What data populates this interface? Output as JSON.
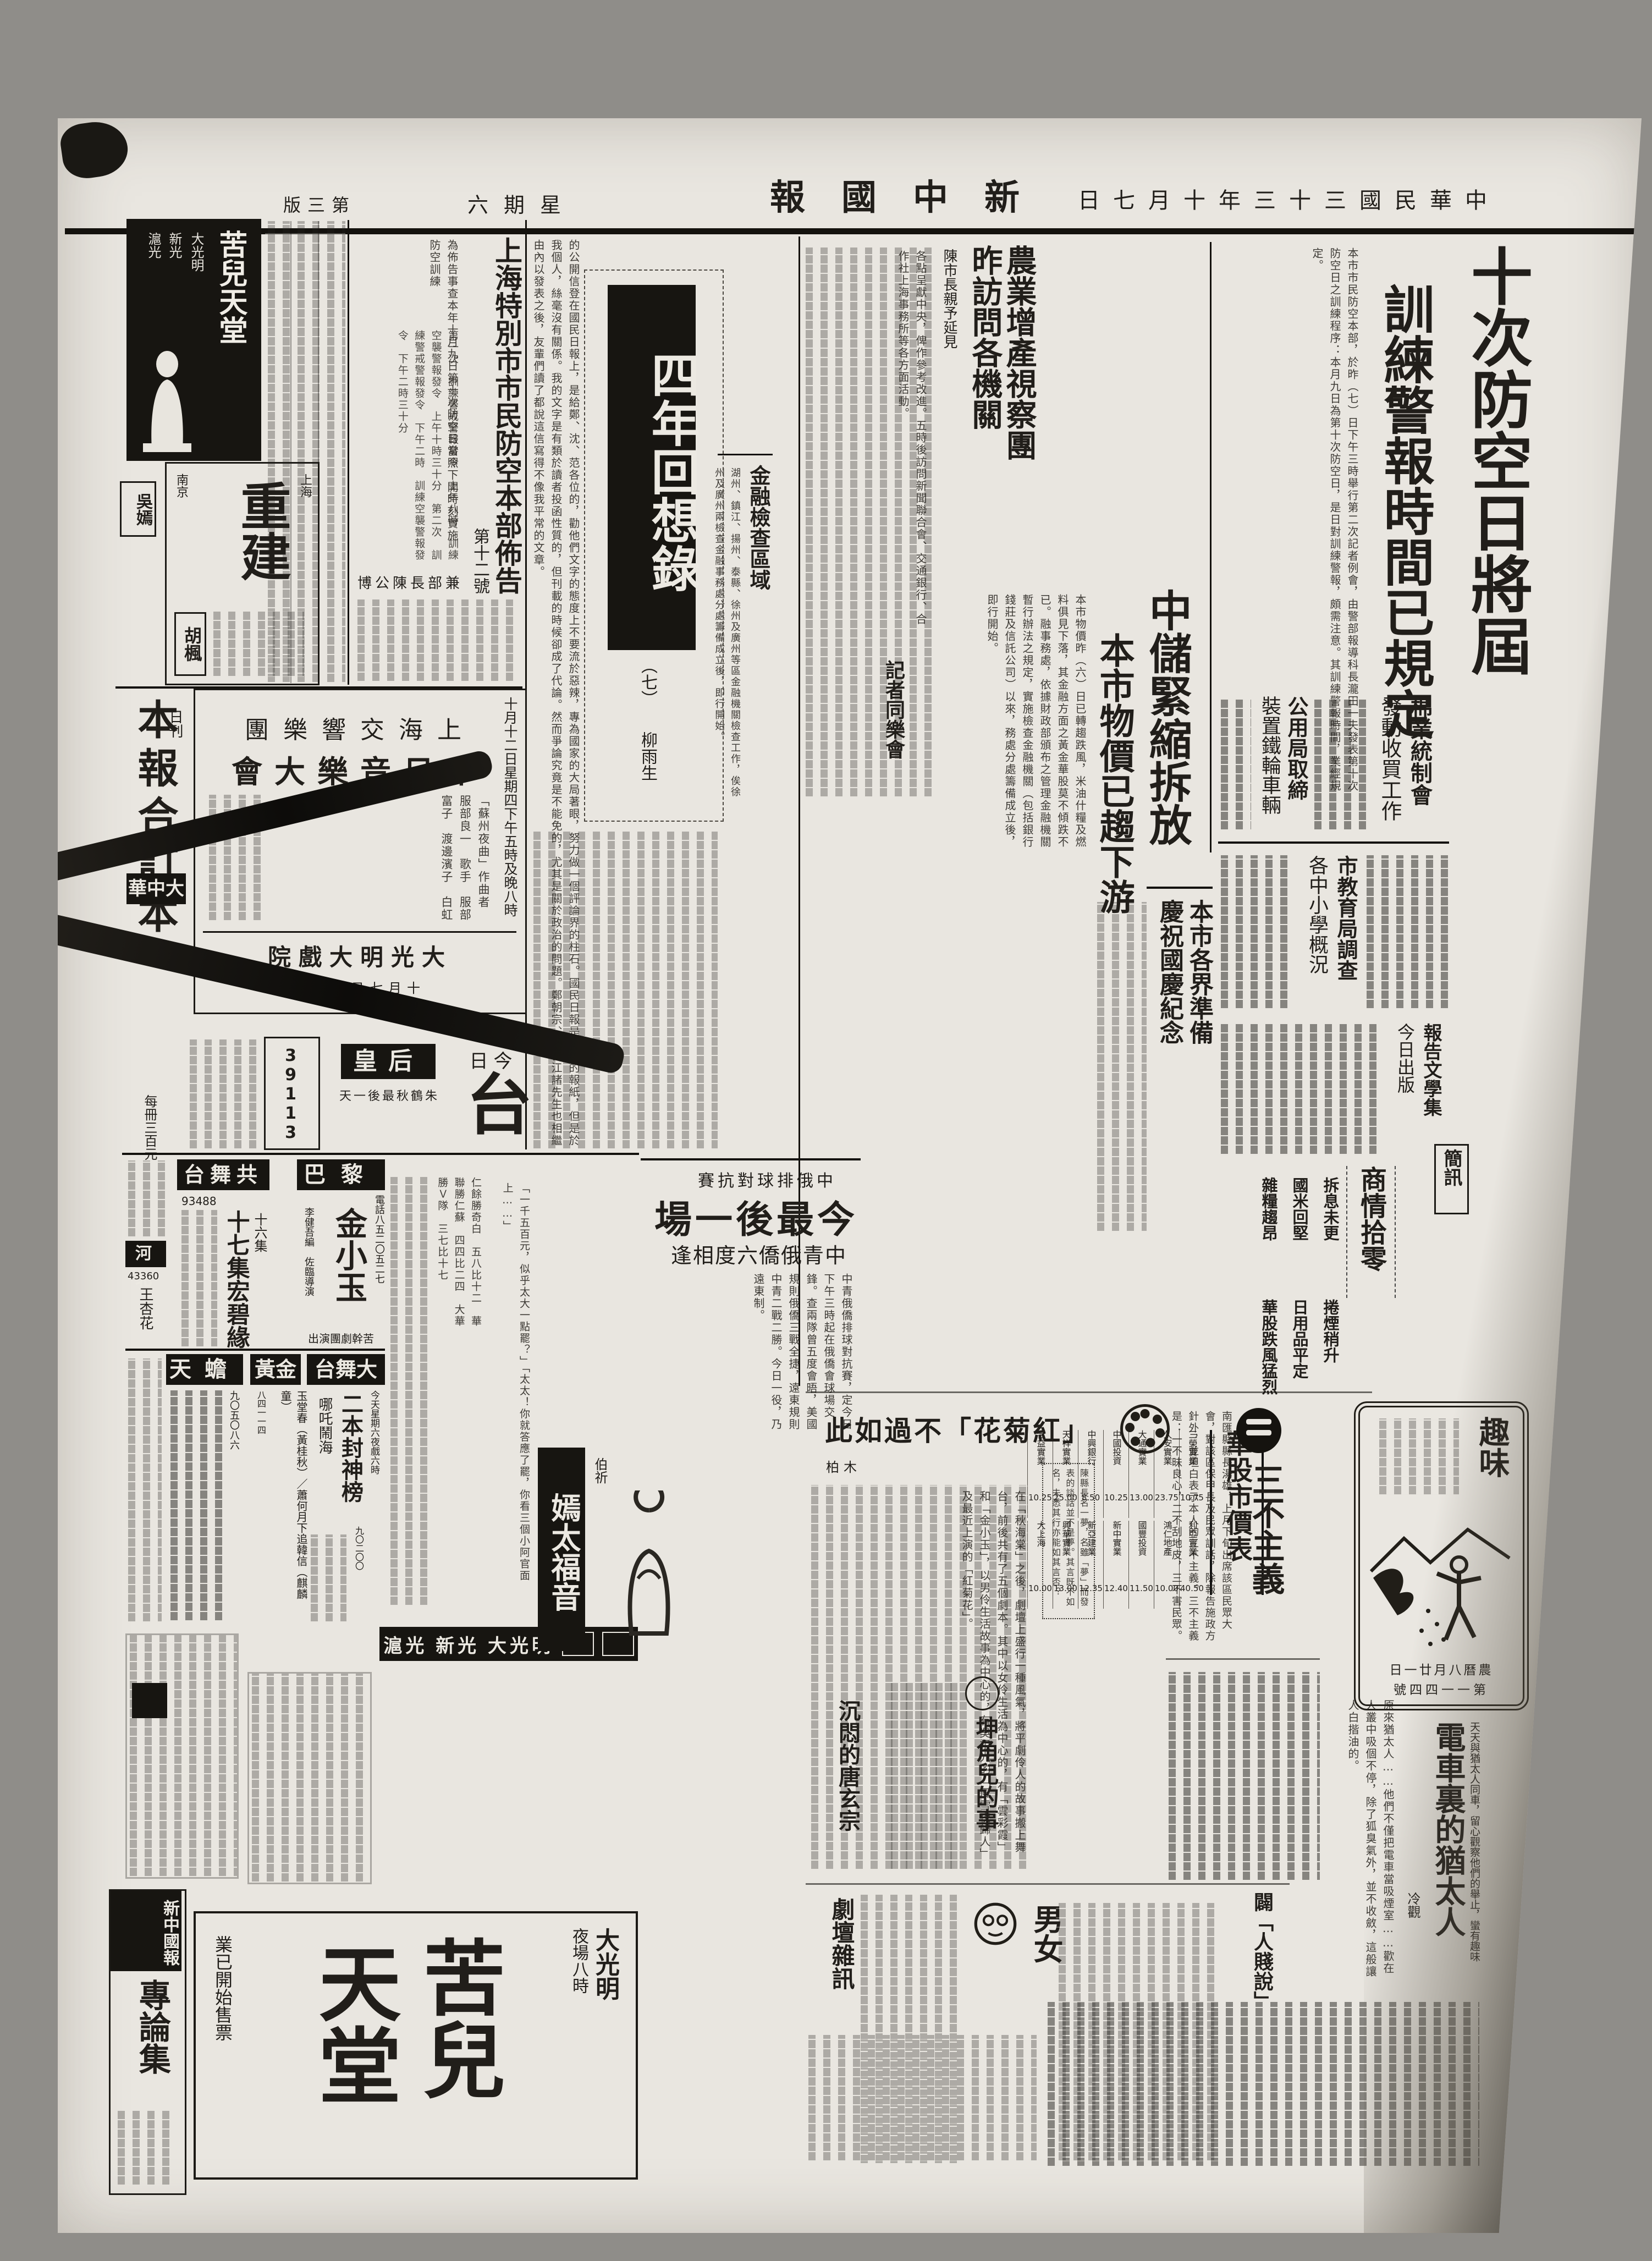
{
  "masthead": {
    "title": "新中國報",
    "title_display": "報國中新",
    "date": "中華民國三十三年十月七日",
    "date_display": "日七月十年三十三國民華中",
    "weekday": "星期六",
    "weekday_display": "六期星",
    "page": "第三版",
    "page_display": "版三第"
  },
  "lead": {
    "title": "十次防空日將屆",
    "subtitle": "訓練警報時間已規定",
    "body": "本市市民防空本部，於昨（七）日下午三時舉行第二次記者例會，由警部報導科長瀧田一夫發表第十次防空日之訓練程序：本月九日為第十次防空日，是日對訓練警報，頗需注意。其訓練警報時間，業經規定。"
  },
  "bulletin": {
    "title": "上海特別市市民防空本部佈告",
    "number": "第十二號",
    "body": "為佈告事查本年十月九日第十次防空日當照下開時刻實施防空訓練",
    "schedule": [
      "第一次　訓練警戒警報發令　上午八時",
      "訓練空襲警報發令　上午十時三十分",
      "第二次　訓練警戒警報發令　下午二時",
      "訓練空襲警報發令　下午二時三十分"
    ],
    "signer": "兼部長陳公博",
    "signer_display": "博公陳長部兼"
  },
  "agri": {
    "title": "農業增產視察團",
    "subtitle": "昨訪問各機關",
    "deck": "陳市長親予延見",
    "body": "各點呈獻中央，俾作參考改進。五時後訪問新聞聯合會、交通銀行、合作社上海事務所等各方面活動。",
    "extra": "記者同樂會"
  },
  "memoir": {
    "title": "四年回想錄",
    "part": "（七）",
    "author": "柳雨生",
    "body": "的公開信登在國民日報上，是給鄭、沈、范各位的，勸他們文字的態度上不要流於惡辣，專為國家的大局著眼，努力做一個評論界的柱石。國民日報是政府的報紙，但是於我個人，絲毫沒有關係。我的文字是有類於讀者投函性質的，但刊載的時候卻成了代論。然而爭論究竟是不能免的，尤其是關於政治的問題。鄭朝宗、范長江諸先生也相繼由內以發表之後，友輩們讀了都說這信寫得不像我平常的文章。"
  },
  "fincheck": {
    "title": "金融檢查區域",
    "body": "湖州、鎮江、揚州、泰縣、徐州及廣州等區金融機關檢查工作，俟徐州及廣州兩檢查金融事務處分處籌備成立後，即行開始。"
  },
  "zhongchu": {
    "title": "中儲緊縮拆放",
    "subtitle": "本市物價已趨下游",
    "body": "本市物價昨（六）日已轉趨跌風，米油什糧及燃料俱見下落，其金融方面之黃金華股莫不傾跌不已。融事務處，依據財政部頒布之管理金融機關暫行辦法之規定，實施檢查金融機關（包括銀行錢莊及信託公司）以來，務處分處籌備成立後，即行開始。"
  },
  "briefs": [
    {
      "title": "棉業統制會",
      "subtitle": "發動收買工作"
    },
    {
      "title": "公用局取締",
      "subtitle": "裝置鐵輪車輛"
    },
    {
      "title": "市教育局調查",
      "subtitle": "各中小學概況"
    },
    {
      "title": "本市各界準備",
      "subtitle": "慶祝國慶紀念"
    },
    {
      "title": "報告文學集",
      "subtitle": "今日出版"
    },
    {
      "title": "簡訊",
      "subtitle": ""
    }
  ],
  "market": {
    "title": "商情拾零",
    "items": [
      "拆息未更",
      "國米回堅",
      "雜糧趨昂",
      "捲煙稍升",
      "日用品平定",
      "華股跌風猛烈"
    ]
  },
  "stocks": {
    "title": "華股市價表",
    "columns": [
      "股名",
      "收盤"
    ],
    "rows": [
      [
        "三榮實業",
        "10.75"
      ],
      [
        "久安實業",
        "23.75"
      ],
      [
        "大通實業",
        "13.00"
      ],
      [
        "中國投資",
        "10.25"
      ],
      [
        "中興銀行",
        "8.50"
      ],
      [
        "天祥實業",
        "25.00"
      ],
      [
        "合益實業",
        "10.25"
      ],
      [
        "利亞實業",
        "40.50"
      ],
      [
        "鴻仁地產",
        "10.00"
      ],
      [
        "國豐投資",
        "11.50"
      ],
      [
        "新中實業",
        "12.40"
      ],
      [
        "新亞建業",
        "12.35"
      ],
      [
        "興華實業",
        "13.00"
      ],
      [
        "大上海",
        "10.00"
      ]
    ]
  },
  "volleyball": {
    "kicker": "中俄排球對抗賽",
    "kicker_display": "賽抗對球排俄中",
    "title": "今最後一場",
    "title_display": "場一後最今",
    "subtitle": "中青俄僑六度相逢",
    "subtitle_display": "逢相度六僑俄青中",
    "body": "中青俄僑排球對抗賽，定今日下午三時起在俄僑會球場交鋒。查兩隊曾五度會晤，美國規則俄僑三戰全捷，遠東規則中青二戰二勝。今日一役，乃遠東制。",
    "scores": [
      "仁餘勝奇白　五八比十二",
      "華聯勝仁蘇　四四比二四",
      "大華勝Ｖ隊　三七比十七"
    ]
  },
  "review": {
    "title": "「紅菊花」不過如此",
    "title_display": "此如過不「花菊紅」",
    "author": "柏木",
    "body": "在「秋海棠」之後，劇壇上盛行一種風氣，將平劇伶人的故事搬上舞台，前後共有了五個劇本。其中以女伶生活為中心的，有「雲彩霞」和「金小玉」，以男伶生活故事為中心的，有吳祖光的「風雪夜歸人」及最近上演的「紅菊花」。"
  },
  "note": {
    "text": "陳縣長名一夢，名雖「夢」而發表的談話並不是夢。其言既不如名，未悉其行亦能如其言否？"
  },
  "sanbu": {
    "title": "三不主義",
    "body": "南匯縣縣長湯雄，上月下旬出席該區民眾大會，對該區保甲長及民眾訓話，除報告施政方針外，並坦白表示本人的三不主義。三不主義是：一不昧良心，二不刮地皮，三不害民眾。"
  },
  "qvwei": {
    "title": "趣味",
    "line1": "農曆八月廿一日",
    "line1_display": "日一廿月八曆農",
    "line2": "第一一四四號",
    "line2_display": "號四四一一第"
  },
  "tram": {
    "title": "電車裏的猶太人",
    "kicker": "天天與猶太人同車，留心觀察他們的舉止，蠻有趣味",
    "author": "冷觀",
    "body": "原來猶太人……他們不僅把電車當吸煙室……歡在人叢中吸個不停，除了狐臭氣外，並不收斂，這般讓人白揩油的。"
  },
  "essays": {
    "kunjue": "坤角兒的事",
    "tang": "沉悶的唐玄宗",
    "drama": "劇壇雜訊",
    "nannv": "男女",
    "pi": "闢「人賤說」"
  },
  "serial": {
    "title": "嫣太福音",
    "author": "伯祈",
    "body": "「一千五百元，似乎太大一點罷？」「太太！你就答應了罷，你看三個小阿官面上……」"
  },
  "ads": {
    "top_movie": {
      "title": "苦兒天堂",
      "theaters": [
        "大光明",
        "新光",
        "滬光"
      ]
    },
    "chongjian": {
      "big": "重建",
      "right": "上海",
      "left": "南京",
      "star": "胡楓"
    },
    "star2": "吳嫣",
    "benbao": {
      "title": "本報合訂本",
      "note": "日刊",
      "price": "每冊三百元"
    },
    "music": {
      "org": "上海交響樂團",
      "org_display": "團樂響交海上",
      "event": "中日音樂大會",
      "event_display": "會大樂音日中",
      "date_line": "十月十二日星期四下午五時及晚八時",
      "details": [
        "「蘇州夜曲」作曲者　服部良一",
        "歌手　服部富子",
        "渡邊濱子",
        "白虹"
      ],
      "venue": "大光明大戲院",
      "venue_display": "院戲大明光大",
      "ticket": "十月七日起售票",
      "ticket_display": "票售起日七月十"
    },
    "dazhonghua": "大中華",
    "dazhonghua_display": "華中大",
    "queen": {
      "name": "皇后",
      "line": "朱鶴秋最後一天",
      "line_display": "天一後最秋鶴朱",
      "big1": "今日",
      "big1_display": "日今",
      "big2": "台"
    },
    "phone_ad": {
      "number": "39113"
    },
    "theaters": [
      {
        "name": "共舞台",
        "name_display": "台舞共",
        "phone": "93488",
        "play": "十七集宏碧緣",
        "line": "十六集",
        "time": "今天星期六夜戲"
      },
      {
        "name": "巴黎",
        "phone": "電話八五二〇五二七",
        "play": "金小玉",
        "credit1": "李健吾編　佐臨導演",
        "credit2": "苦幹劇團演出",
        "credit2_display": "出演團劇幹苦"
      },
      {
        "name": "河北",
        "phone": "43360",
        "star": "王杏花"
      },
      {
        "name": "天蟾",
        "phone": "九〇五〇八六"
      },
      {
        "name": "黃金",
        "phone": "八四一一四",
        "plays": "玉堂春（黃桂秋）／蕭何月下追韓信（麒麟童）"
      },
      {
        "name": "大舞台",
        "name_display": "台舞大",
        "phone": "九〇二〇〇",
        "play": "二本封神榜",
        "play2": "哪吒鬧海",
        "time": "今天星期六夜戲六時"
      }
    ],
    "strip": [
      "滬光",
      "新光",
      "大光明"
    ],
    "bottom_movie": {
      "big_right": "苦兒",
      "big_left": "天堂",
      "theater": "大光明",
      "time": "夜場八時",
      "note": "業已開始售票"
    },
    "zhuanlunji": {
      "brand": "新中國報",
      "title": "專論集"
    }
  }
}
